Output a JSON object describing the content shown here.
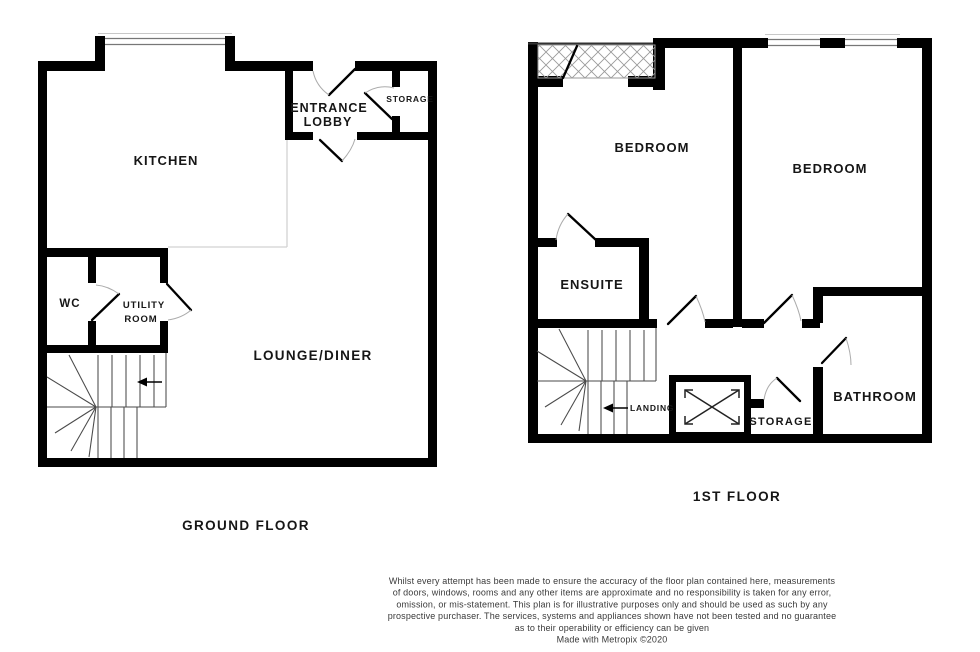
{
  "ground_floor": {
    "label": "GROUND FLOOR",
    "rooms": {
      "kitchen": "KITCHEN",
      "entrance_line1": "ENTRANCE",
      "entrance_line2": "LOBBY",
      "storage": "STORAGE",
      "wc": "WC",
      "utility_line1": "UTILITY",
      "utility_line2": "ROOM",
      "lounge_diner": "LOUNGE/DINER"
    }
  },
  "first_floor": {
    "label": "1ST FLOOR",
    "rooms": {
      "bedroom_left": "BEDROOM",
      "bedroom_right": "BEDROOM",
      "ensuite": "ENSUITE",
      "landing": "LANDING",
      "storage": "STORAGE",
      "bathroom": "BATHROOM"
    }
  },
  "disclaimer": {
    "lines": [
      "Whilst every attempt has been made to ensure the accuracy of the floor plan contained here, measurements",
      "of doors, windows, rooms and any other items are approximate and no responsibility is taken for any error,",
      "omission, or mis-statement. This plan is for illustrative purposes only and should be used as such by any",
      "prospective purchaser. The services, systems and appliances shown have not been tested and no guarantee",
      "as to their operability or efficiency can be given",
      "Made with Metropix ©2020"
    ]
  },
  "colors": {
    "wall": "#000000",
    "background": "#ffffff",
    "window_line": "#777777",
    "stair_line": "#4a4a4a",
    "door_arc": "#ababab",
    "kitchen_divider": "#d2d2d2",
    "text": "#161616"
  }
}
